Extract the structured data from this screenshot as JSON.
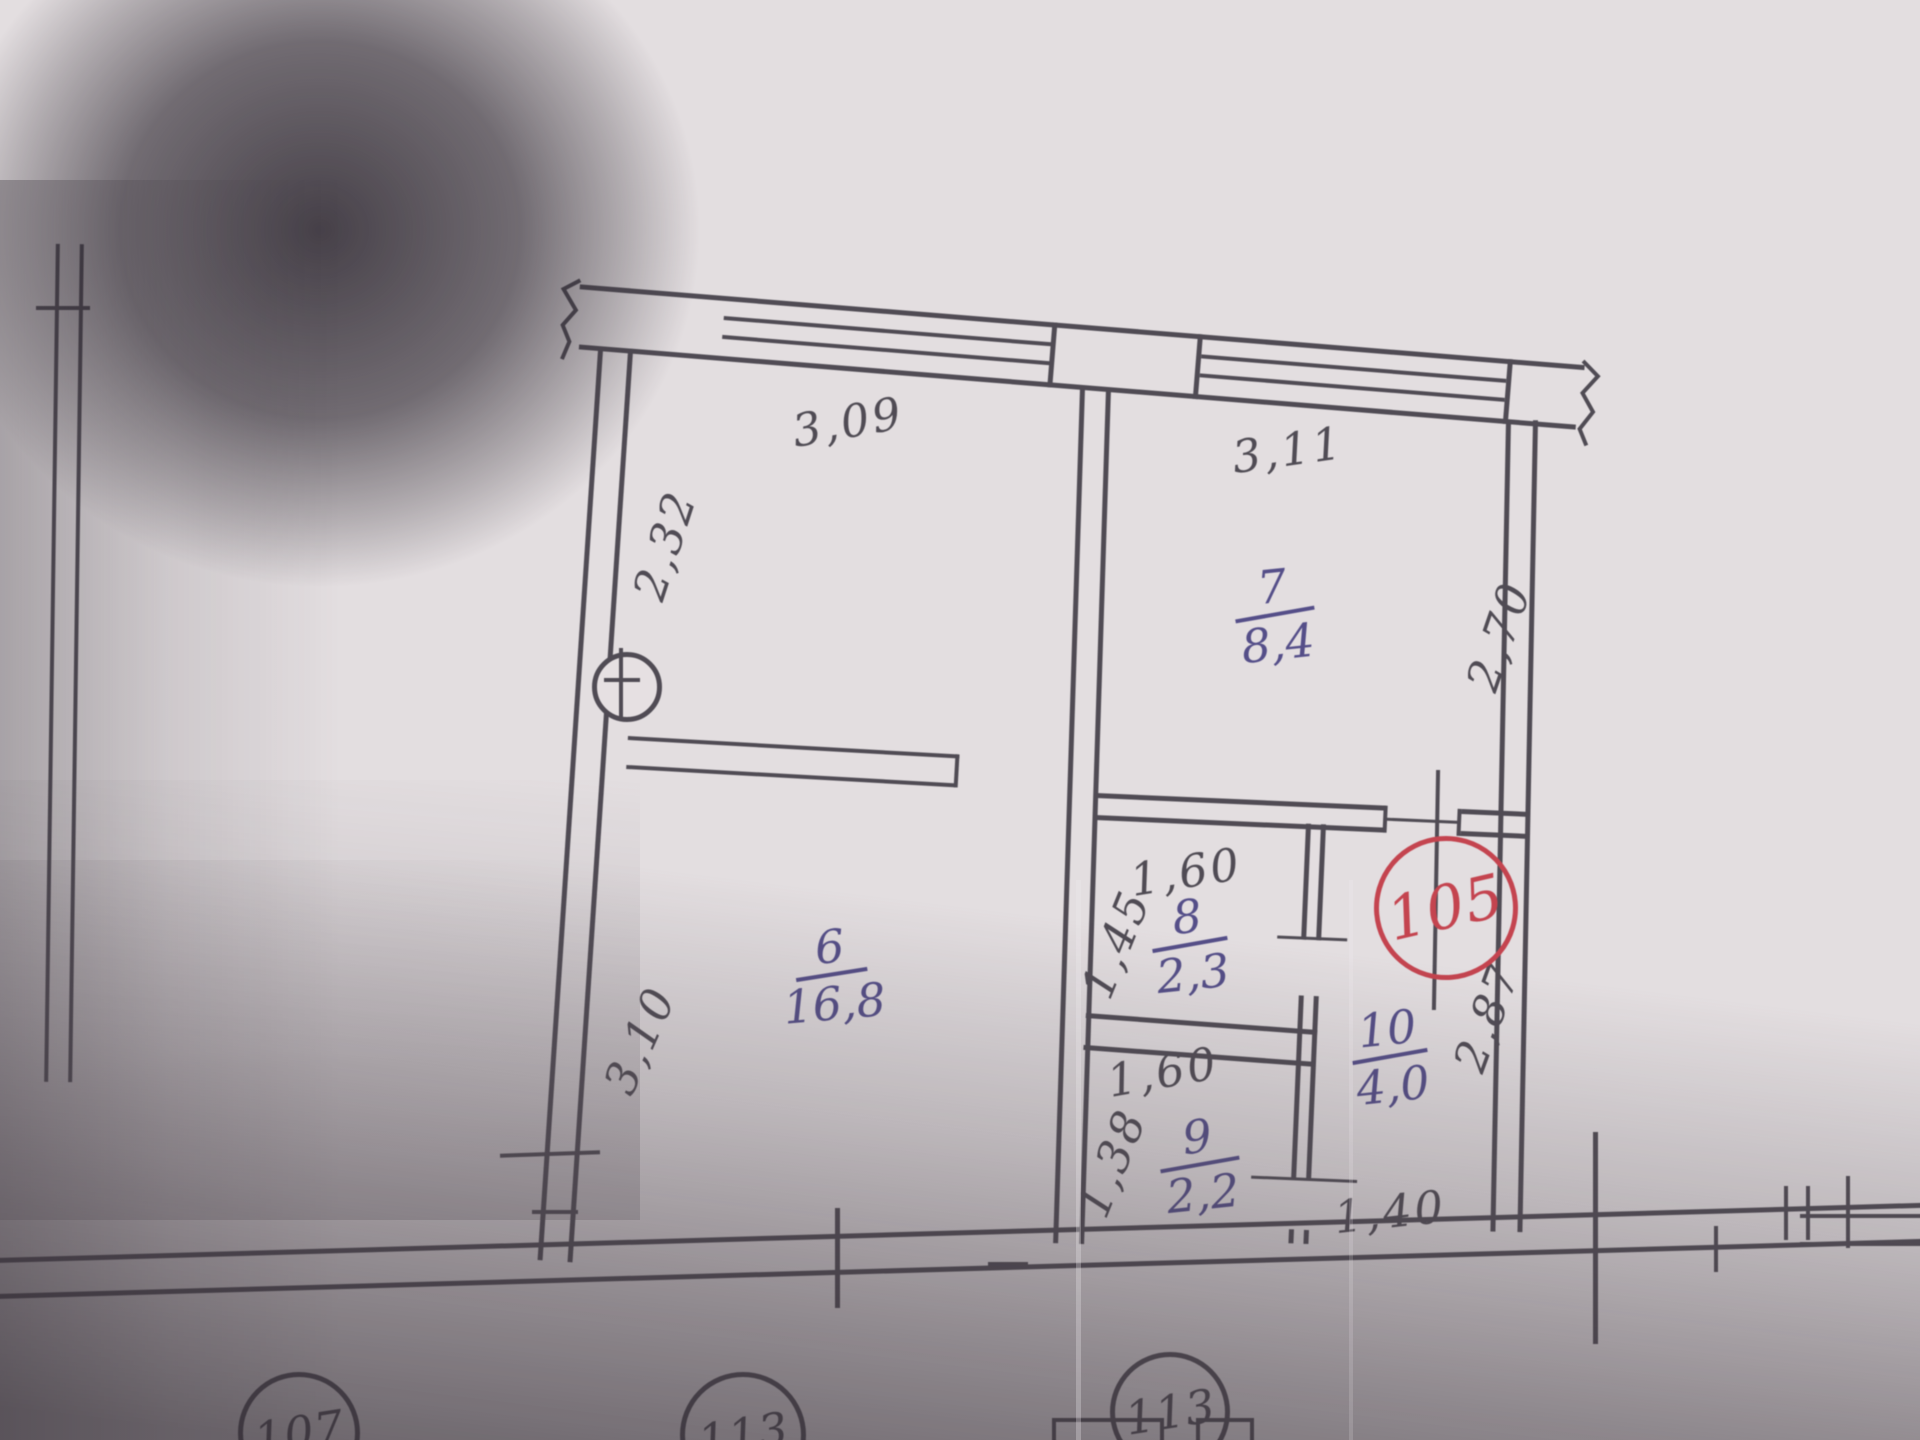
{
  "plan": {
    "apartment_number": "105",
    "rooms": [
      {
        "number": "6",
        "area": "16,8"
      },
      {
        "number": "7",
        "area": "8,4"
      },
      {
        "number": "8",
        "area": "2,3"
      },
      {
        "number": "9",
        "area": "2,2"
      },
      {
        "number": "10",
        "area": "4,0"
      }
    ],
    "dimensions": {
      "room6_top_width": "3,09",
      "room7_top_width": "3,11",
      "left_wall_upper": "2,32",
      "room6_left_height": "3,10",
      "room7_right_height": "2,70",
      "hall_right_height": "2,87",
      "room8_top_width": "1,60",
      "room8_left_height": "1,45",
      "room9_top_width": "1,60",
      "room9_left_height": "1,38",
      "hall_bottom_width": "1,40"
    },
    "neighbor_units": [
      "107",
      "113",
      "113"
    ]
  },
  "colors": {
    "ink": "#46424b",
    "blue_ink": "#4b4583",
    "red_ink": "#c23a46"
  }
}
